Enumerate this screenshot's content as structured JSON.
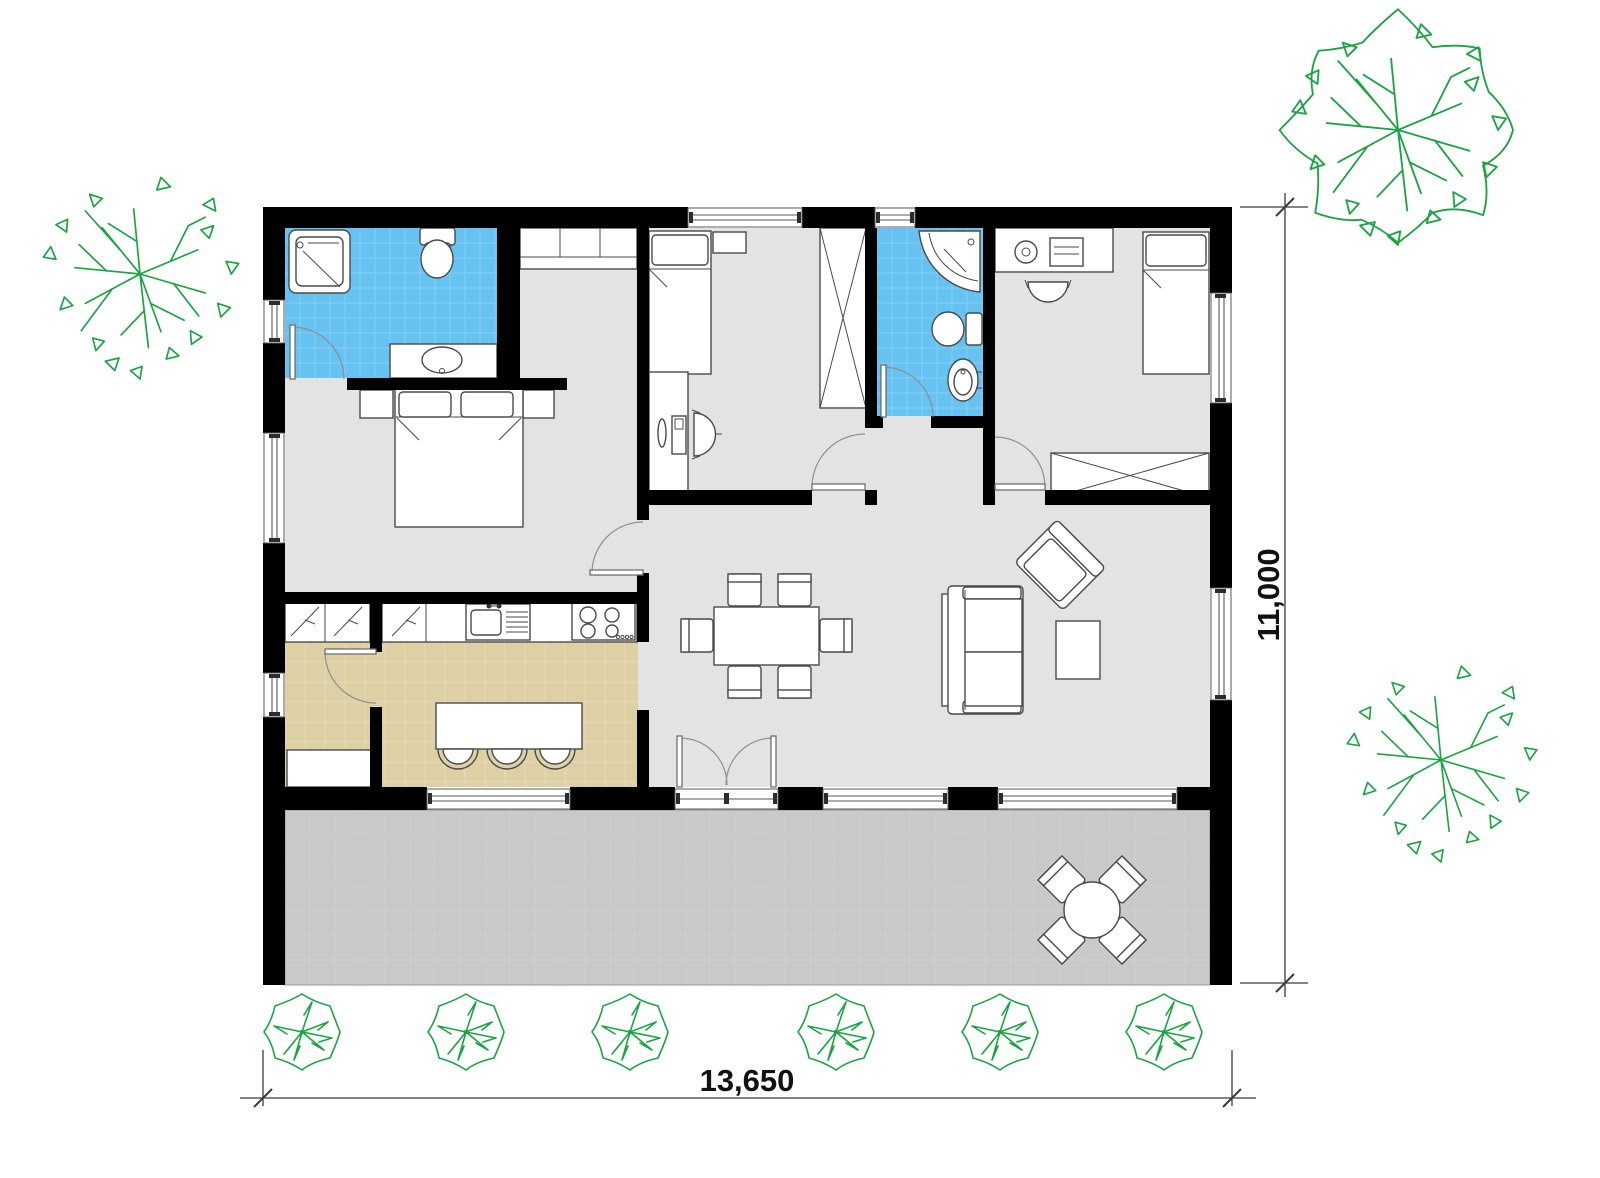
{
  "title": "single-storey house floor plan",
  "dimensions": {
    "width_label": "13,650",
    "height_label": "11,000"
  },
  "colors": {
    "wall": "#000000",
    "floor": "#e3e3e3",
    "terrace": "#c9c9c9",
    "bathroom": "#66c2f0",
    "kitchen": "#ddd0a4",
    "line": "#4a4a4a",
    "tree": "#1ba442",
    "dim": "#111111",
    "bg": "#ffffff"
  }
}
